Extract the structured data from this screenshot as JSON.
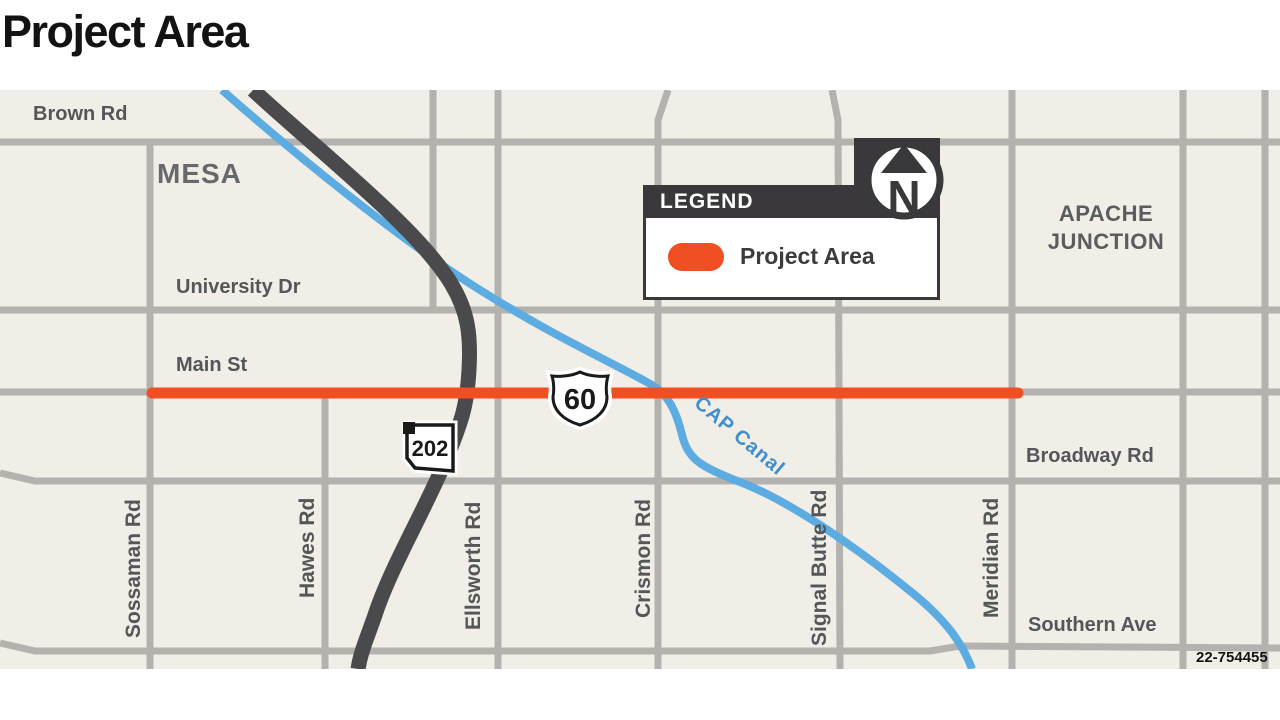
{
  "title": "Project Area",
  "map": {
    "cities": {
      "mesa": "MESA",
      "apache_line1": "APACHE",
      "apache_line2": "JUNCTION"
    },
    "h_streets": [
      "Brown Rd",
      "University Dr",
      "Main St",
      "Broadway Rd",
      "Southern Ave"
    ],
    "v_streets": [
      "Sossaman Rd",
      "Hawes Rd",
      "Ellsworth Rd",
      "Crismon Rd",
      "Signal Butte Rd",
      "Meridian Rd"
    ],
    "canal_label": "CAP Canal",
    "shields": {
      "us_60": "60",
      "loop_202": "202"
    },
    "figure_number": "22-754455"
  },
  "legend": {
    "header": "LEGEND",
    "items": [
      {
        "label": "Project Area",
        "swatch_color": "#F04E23"
      }
    ]
  },
  "north": {
    "label": "N"
  },
  "colors": {
    "map-bg": "#F0EEE6",
    "road": "#B4B2AF",
    "freeway": "#4A494C",
    "canal": "#5CACE2",
    "orange": "#F04E23",
    "legend-dark": "#3A383A",
    "label": "#55565A",
    "canal-label": "#3E8ECF",
    "title": "#131313"
  }
}
